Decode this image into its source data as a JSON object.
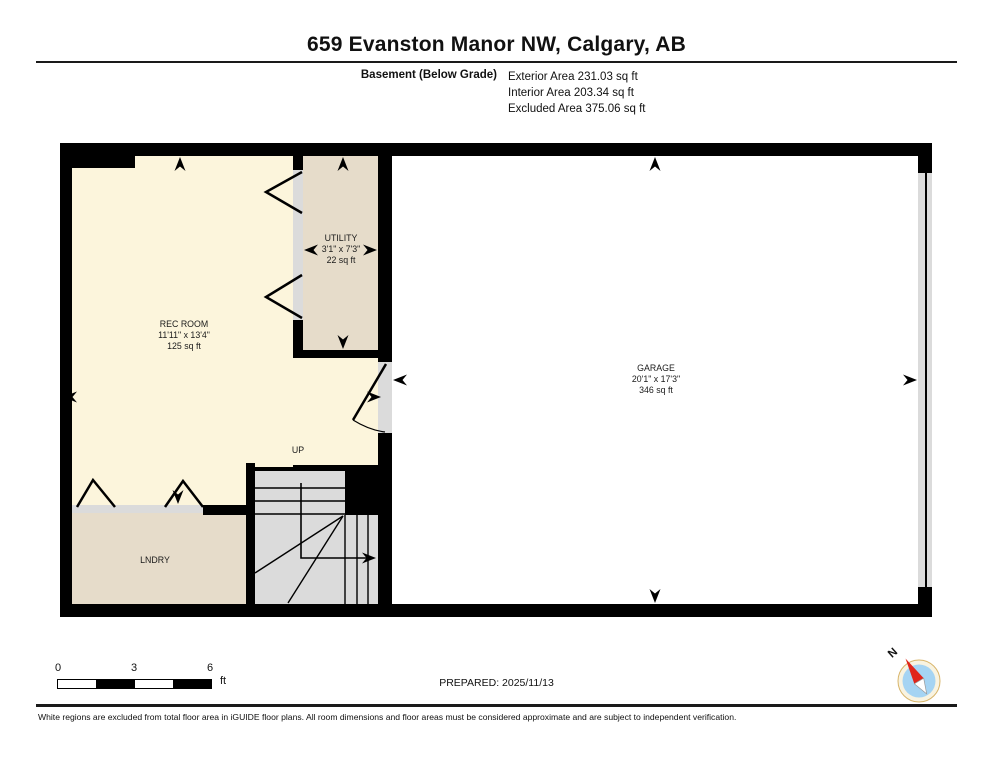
{
  "header": {
    "title": "659 Evanston Manor NW, Calgary, AB",
    "floor_label": "Basement (Below Grade)",
    "exterior_area": "Exterior Area 231.03 sq ft",
    "interior_area": "Interior Area 203.34 sq ft",
    "excluded_area": "Excluded Area 375.06 sq ft"
  },
  "rooms": {
    "rec_room": {
      "name": "REC ROOM",
      "dimensions": "11'11\" x 13'4\"",
      "area": "125 sq ft"
    },
    "utility": {
      "name": "UTILITY",
      "dimensions": "3'1\" x 7'3\"",
      "area": "22 sq ft"
    },
    "garage": {
      "name": "GARAGE",
      "dimensions": "20'1\" x 17'3\"",
      "area": "346 sq ft"
    },
    "laundry": {
      "name": "LNDRY"
    },
    "stairs": {
      "direction_label": "UP"
    }
  },
  "scale_bar": {
    "tick_0": "0",
    "tick_3": "3",
    "tick_6": "6",
    "unit": "ft"
  },
  "footer": {
    "prepared": "PREPARED: 2025/11/13",
    "compass_label": "N",
    "disclaimer": "White regions are excluded from total floor area in iGUIDE floor plans. All room dimensions and floor areas must be considered approximate and are subject to independent verification."
  },
  "colors": {
    "wall": "#000000",
    "included_room_fill": "#FCF5DC",
    "excluded_room_fill": "#E6DCCA",
    "stairs_fill": "#DBDBDB",
    "compass_blue": "#A5D4F3",
    "compass_red": "#E0251B",
    "compass_ring": "#F8F3E1"
  }
}
